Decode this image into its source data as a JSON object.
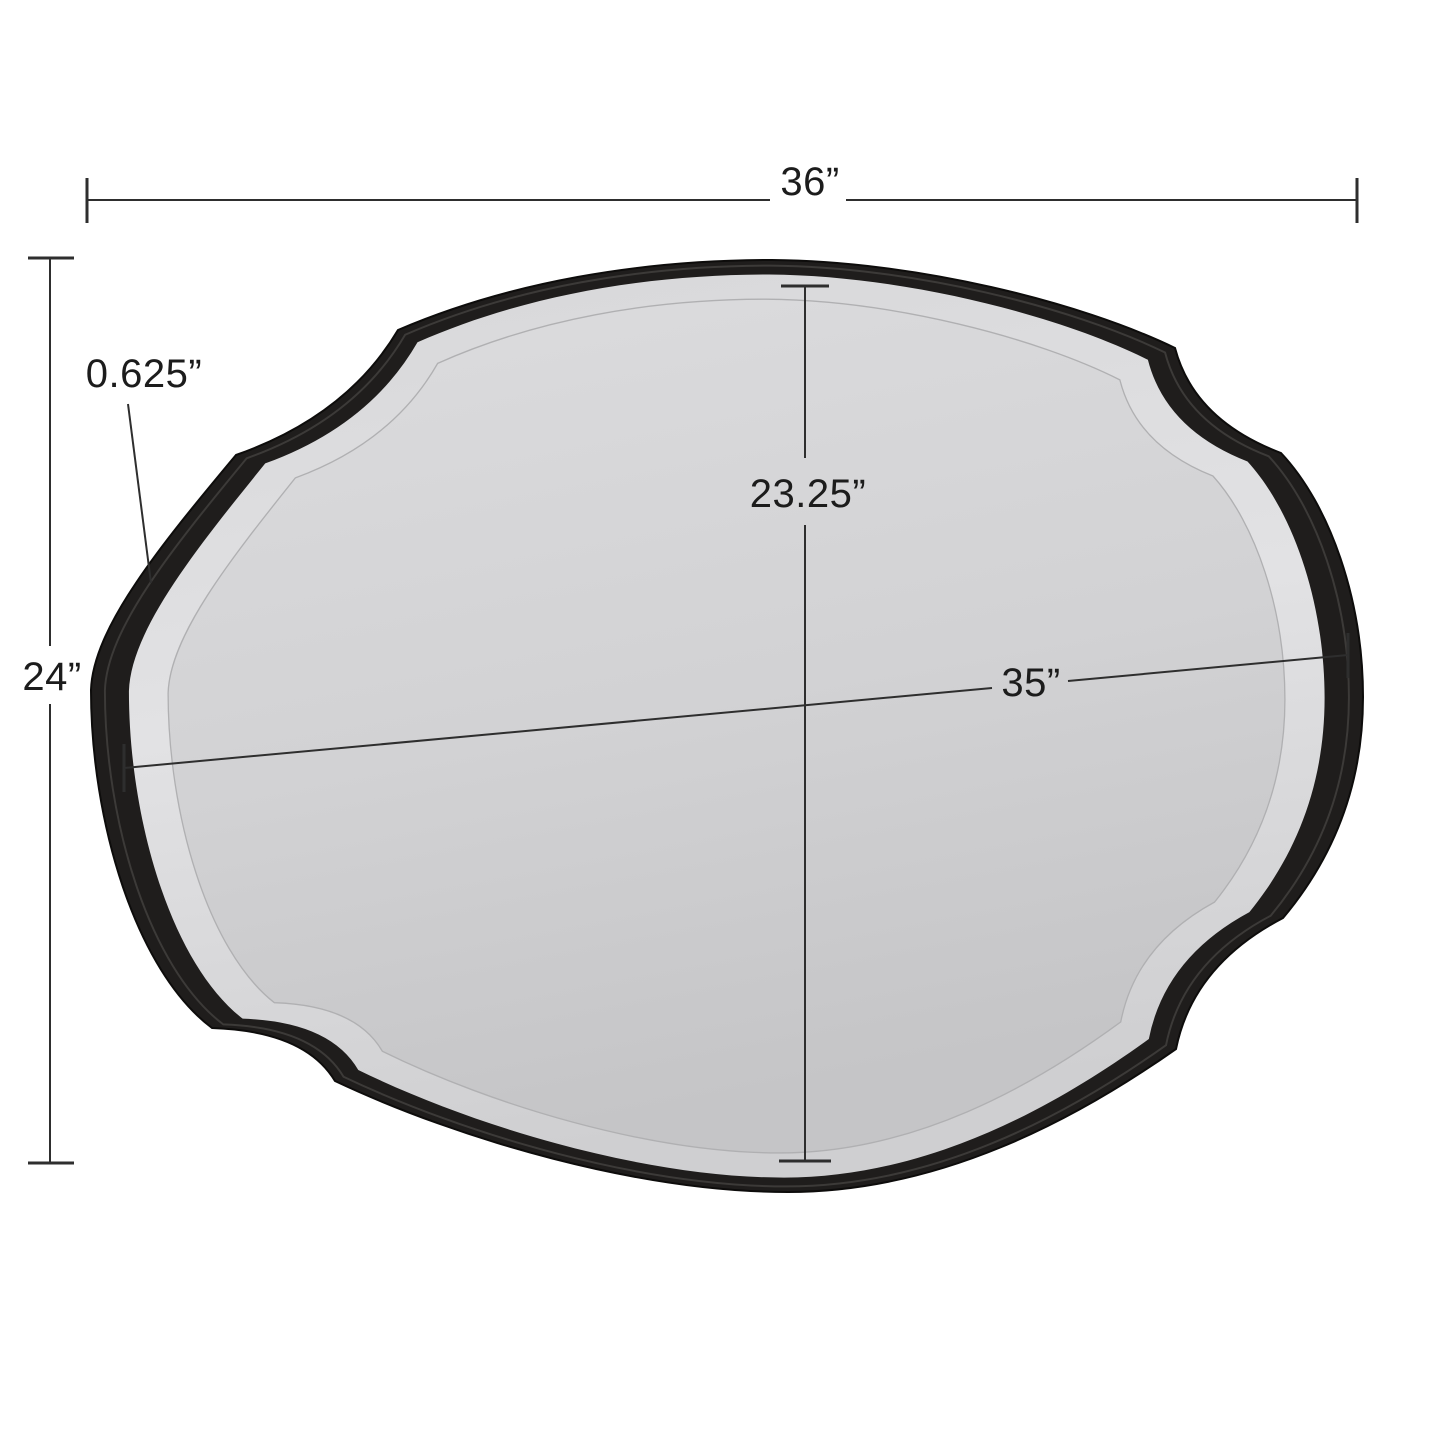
{
  "diagram": {
    "type": "product-dimension-diagram",
    "product": "scalloped-oval-wall-mirror",
    "dimensions": {
      "overall_width": "36”",
      "overall_height": "24”",
      "frame_depth": "0.625”",
      "mirror_height": "23.25”",
      "mirror_width": "35”"
    },
    "colors": {
      "background": "#ffffff",
      "frame": "#1f1d1c",
      "frame_highlight": "#3c3a38",
      "bevel": "#dfdfe1",
      "glass_light": "#dadadc",
      "glass_dark": "#c5c5c7",
      "dimension_line": "#2e2e2e",
      "text": "#1c1c1c"
    }
  }
}
